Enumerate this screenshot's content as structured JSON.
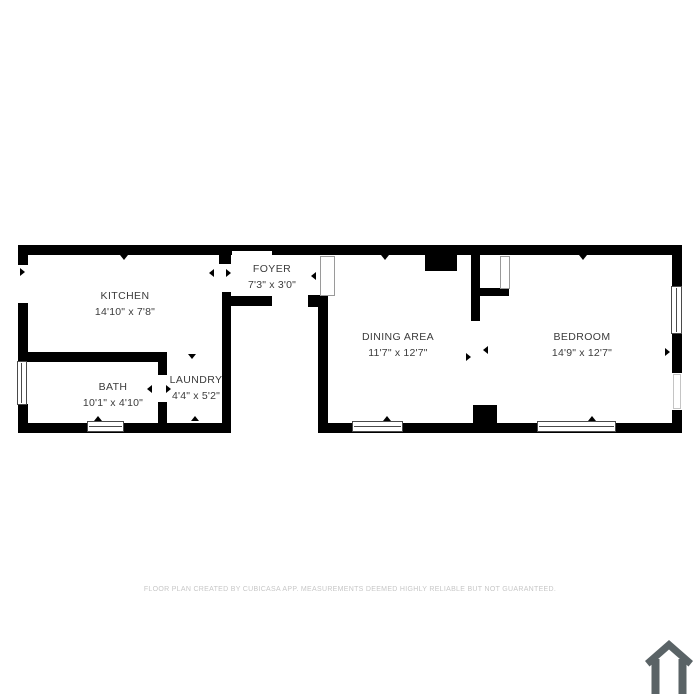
{
  "rooms": {
    "kitchen": {
      "name": "KITCHEN",
      "dims": "14'10\" x 7'8\""
    },
    "foyer": {
      "name": "FOYER",
      "dims": "7'3\" x 3'0\""
    },
    "bath": {
      "name": "BATH",
      "dims": "10'1\" x 4'10\""
    },
    "laundry": {
      "name": "LAUNDRY",
      "dims": "4'4\" x 5'2\""
    },
    "dining": {
      "name": "DINING AREA",
      "dims": "11'7\" x 12'7\""
    },
    "bedroom": {
      "name": "BEDROOM",
      "dims": "14'9\" x 12'7\""
    }
  },
  "footer": {
    "disclaimer": "FLOOR PLAN CREATED BY CUBICASA APP. MEASUREMENTS DEEMED HIGHLY RELIABLE BUT NOT GUARANTEED."
  },
  "branding": {
    "logo_icon": "cubicasa-house-icon"
  },
  "colors": {
    "wall": "#000000",
    "room_label": "#3b3b3b",
    "disclaimer_text": "#c7c7c7",
    "logo": "#5a6366",
    "background": "#ffffff"
  }
}
